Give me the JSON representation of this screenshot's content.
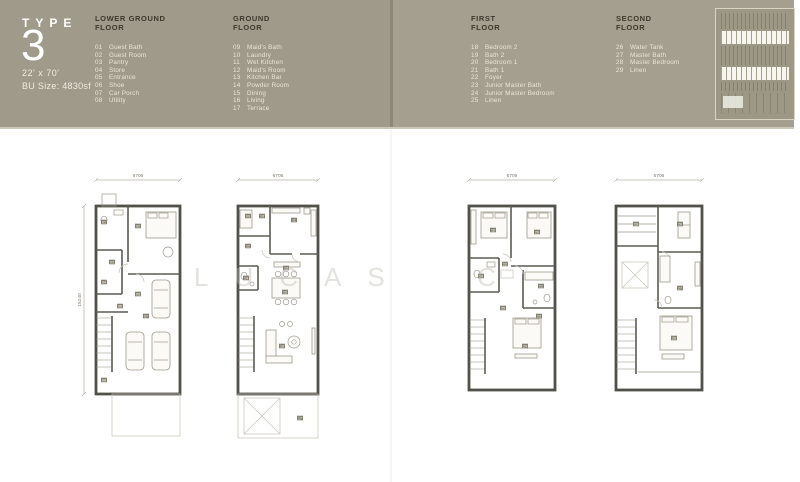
{
  "header": {
    "type_label": "TYPE",
    "type_number": "3",
    "size": "22' x 70'",
    "bu_size": "BU Size: 4830sf"
  },
  "colors": {
    "band": "#9f9a8a",
    "legend_title": "#3d3a2d",
    "legend_item": "#ebe7d9",
    "plan_wall": "#51504a"
  },
  "legends": [
    {
      "title_lines": [
        "LOWER GROUND",
        "FLOOR"
      ],
      "items": [
        {
          "num": "01",
          "name": "Guest Bath"
        },
        {
          "num": "02",
          "name": "Guest Room"
        },
        {
          "num": "03",
          "name": "Pantry"
        },
        {
          "num": "04",
          "name": "Store"
        },
        {
          "num": "05",
          "name": "Entrance"
        },
        {
          "num": "06",
          "name": "Shoe"
        },
        {
          "num": "07",
          "name": "Car Porch"
        },
        {
          "num": "08",
          "name": "Utility"
        }
      ]
    },
    {
      "title_lines": [
        "GROUND",
        "FLOOR"
      ],
      "items": [
        {
          "num": "09",
          "name": "Maid's Bath"
        },
        {
          "num": "10",
          "name": "Laundry"
        },
        {
          "num": "11",
          "name": "Wet Kitchen"
        },
        {
          "num": "12",
          "name": "Maid's Room"
        },
        {
          "num": "13",
          "name": "Kitchen Bar"
        },
        {
          "num": "14",
          "name": "Powder Room"
        },
        {
          "num": "15",
          "name": "Dining"
        },
        {
          "num": "16",
          "name": "Living"
        },
        {
          "num": "17",
          "name": "Terrace"
        }
      ]
    },
    {
      "title_lines": [
        "FIRST",
        "FLOOR"
      ],
      "items": [
        {
          "num": "18",
          "name": "Bedroom 2"
        },
        {
          "num": "19",
          "name": "Bath 2"
        },
        {
          "num": "20",
          "name": "Bedroom 1"
        },
        {
          "num": "21",
          "name": "Bath 1"
        },
        {
          "num": "22",
          "name": "Foyer"
        },
        {
          "num": "23",
          "name": "Junior Master Bath"
        },
        {
          "num": "24",
          "name": "Junior Master Bedroom"
        },
        {
          "num": "25",
          "name": "Linen"
        }
      ]
    },
    {
      "title_lines": [
        "SECOND",
        "FLOOR"
      ],
      "items": [
        {
          "num": "26",
          "name": "Water Tank"
        },
        {
          "num": "27",
          "name": "Master Bath"
        },
        {
          "num": "28",
          "name": "Master Bedroom"
        },
        {
          "num": "29",
          "name": "Linen"
        }
      ]
    }
  ],
  "watermark": "LUCAS  C",
  "plans": [
    {
      "name": "lower-ground-floor",
      "width_dim": "6706",
      "depth_dim": "15240",
      "tags": [
        "01",
        "02",
        "03",
        "04",
        "05",
        "06",
        "07",
        "08"
      ]
    },
    {
      "name": "ground-floor",
      "width_dim": "6706",
      "tags": [
        "09",
        "10",
        "11",
        "12",
        "13",
        "14",
        "15",
        "16",
        "17"
      ]
    },
    {
      "name": "first-floor",
      "width_dim": "6706",
      "tags": [
        "18",
        "19",
        "20",
        "21",
        "22",
        "23",
        "24",
        "25"
      ]
    },
    {
      "name": "second-floor",
      "width_dim": "6706",
      "tags": [
        "26",
        "27",
        "28",
        "29"
      ]
    }
  ]
}
